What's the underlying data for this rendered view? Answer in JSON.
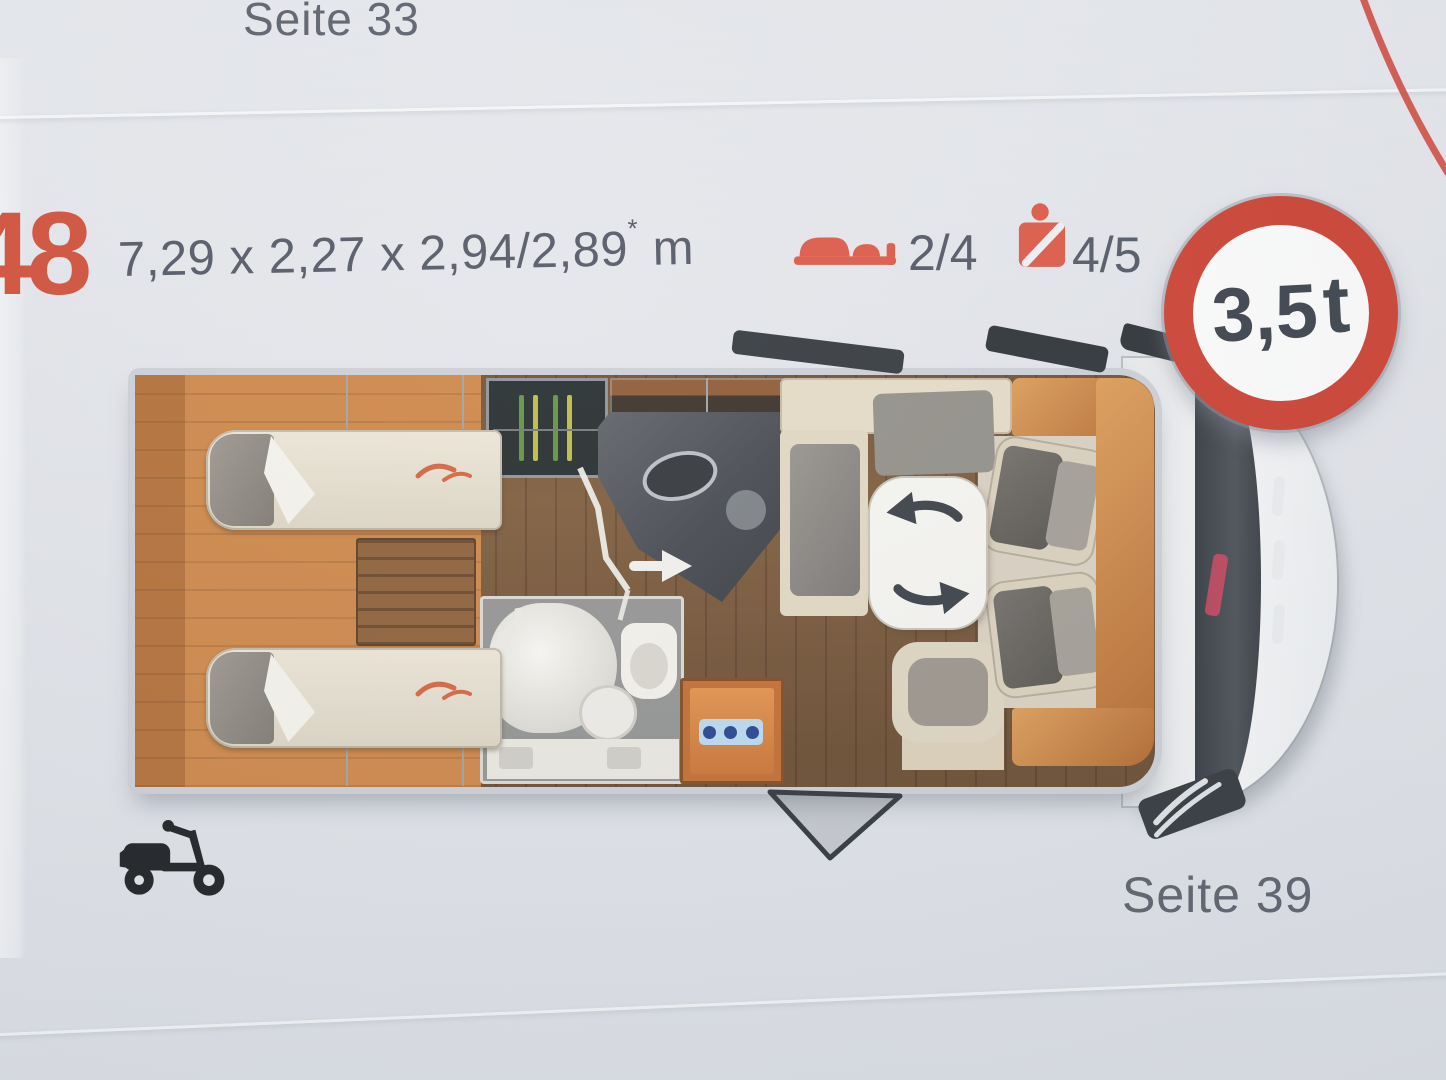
{
  "page": {
    "top_page_ref": "Seite 33",
    "bottom_page_ref": "Seite 39"
  },
  "model": {
    "number": "48",
    "dimensions_value": "7,29 x 2,27 x 2,94/2,89",
    "dimensions_note_mark": "*",
    "dimensions_unit": "m",
    "berths": "2/4",
    "belted_seats": "4/5",
    "weight_limit_value": "3,5",
    "weight_limit_unit": "t"
  },
  "colors": {
    "accent_orange": "#d04a34",
    "text_dark": "#4e5360",
    "sign_red": "#cb3b2c",
    "furniture_wood": "#cc8342",
    "floor_wood": "#7b5837"
  }
}
